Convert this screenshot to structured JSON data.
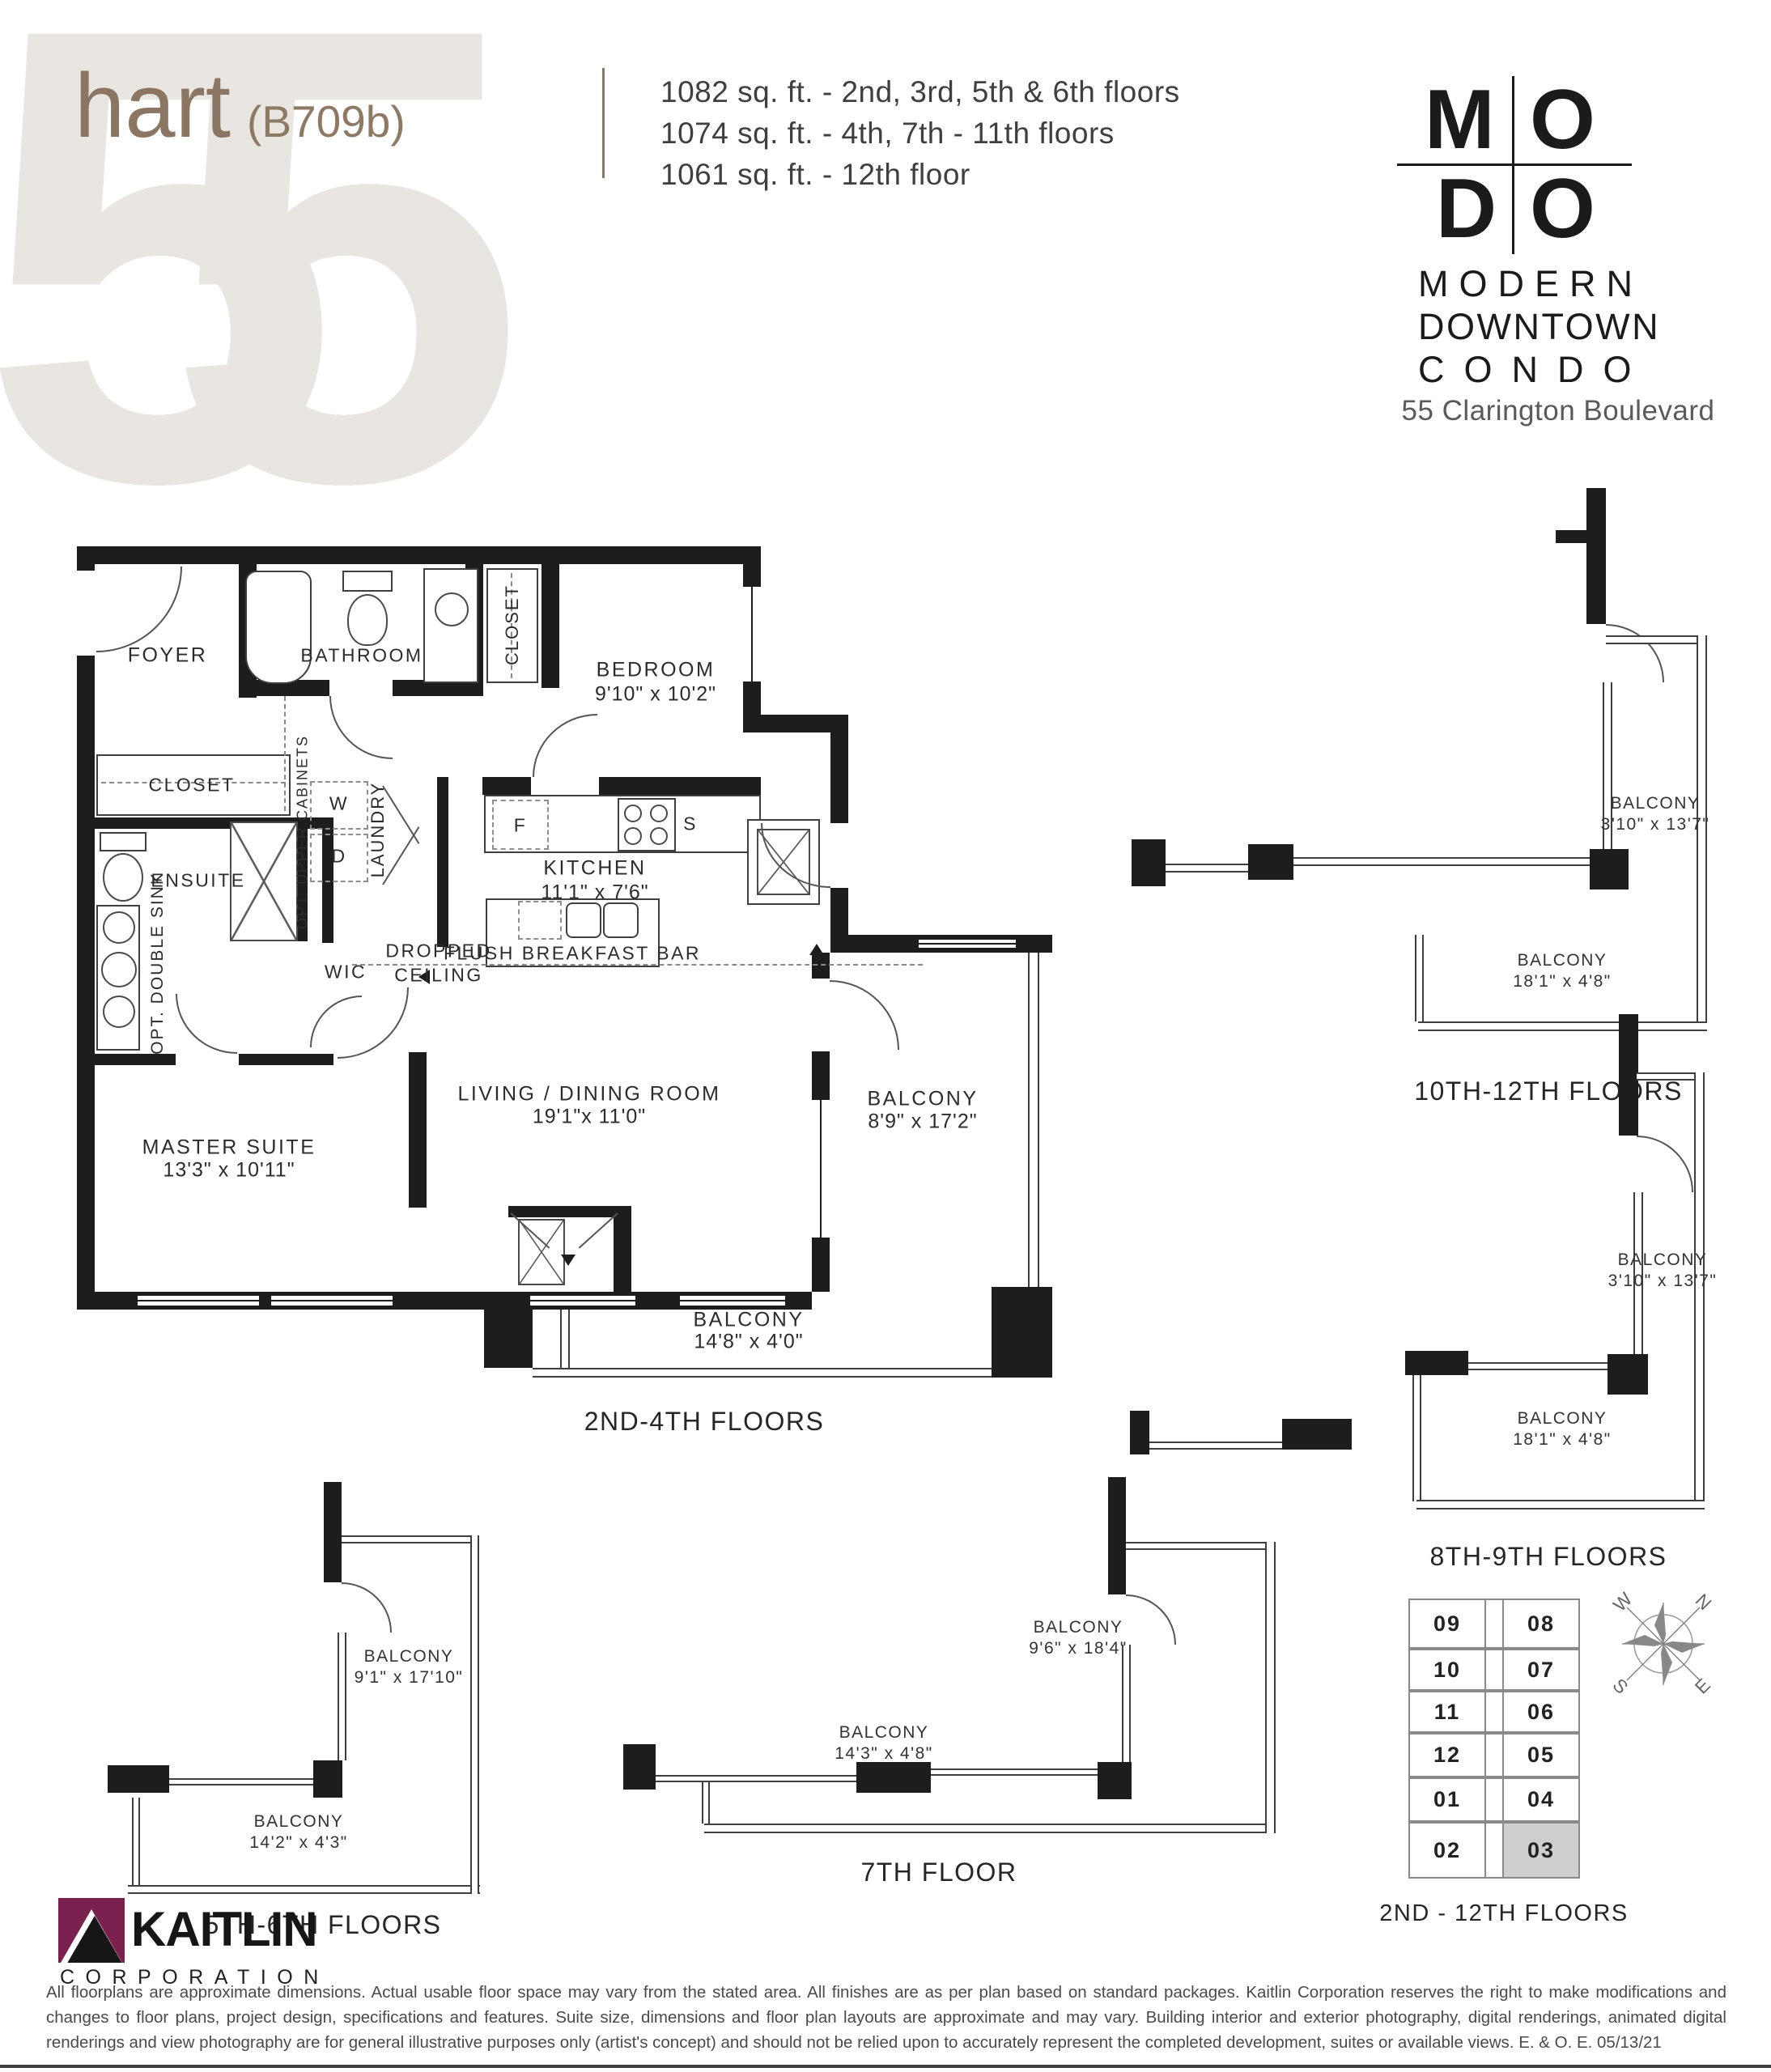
{
  "colors": {
    "accent_brown": "#8b7563",
    "wall_black": "#1d1d1d",
    "watermark_gray": "#e9e6e1",
    "kaitlin_maroon": "#7b2150",
    "highlight_gray": "#cfcfcf"
  },
  "header": {
    "watermark": "55",
    "title": "hart",
    "title_suffix": "(B709b)",
    "sqft_lines": [
      "1082 sq. ft. - 2nd, 3rd, 5th & 6th floors",
      "1074 sq. ft. - 4th, 7th - 11th floors",
      "1061 sq. ft. - 12th floor"
    ],
    "logo": {
      "l1": "M",
      "l2": "O",
      "l3": "D",
      "l4": "O",
      "word1": "MODERN",
      "word2": "DOWNTOWN",
      "word3": "CONDO"
    },
    "address": "55 Clarington Boulevard"
  },
  "main_plan": {
    "caption": "2ND-4TH FLOORS",
    "labels": {
      "foyer": "FOYER",
      "bathroom": "BATHROOM",
      "closet_top": "CLOSET",
      "closet_mid": "CLOSET",
      "bedroom_name": "BEDROOM",
      "bedroom_dims": "9'10\" x 10'2\"",
      "ensuite": "ENSUITE",
      "opt_double_sink": "OPT. DOUBLE SINK",
      "opt_upper_cabinets": "OPT. UPPER CABINETS",
      "laundry": "LAUNDRY",
      "washer": "W",
      "dryer": "D",
      "wic": "WIC",
      "kitchen_name": "KITCHEN",
      "kitchen_dims": "11'1\" x 7'6\"",
      "dropped_1": "DROPPED",
      "dropped_2": "CEILING",
      "breakfast_bar": "FLUSH BREAKFAST BAR",
      "fridge": "F",
      "stove": "S",
      "master_name": "MASTER SUITE",
      "master_dims": "13'3\" x 10'11\"",
      "living_name": "LIVING / DINING ROOM",
      "living_dims": "19'1\"x 11'0\"",
      "balcony_side_name": "BALCONY",
      "balcony_side_dims": "8'9\" x 17'2\"",
      "balcony_bottom_name": "BALCONY",
      "balcony_bottom_dims": "14'8\" x 4'0\""
    }
  },
  "variants": [
    {
      "caption": "10TH-12TH FLOORS",
      "b1_name": "BALCONY",
      "b1_dims": "3'10\" x 13'7\"",
      "b2_name": "BALCONY",
      "b2_dims": "18'1\" x 4'8\""
    },
    {
      "caption": "8TH-9TH FLOORS",
      "b1_name": "BALCONY",
      "b1_dims": "3'10\" x 13'7\"",
      "b2_name": "BALCONY",
      "b2_dims": "18'1\" x 4'8\""
    },
    {
      "caption": "5TH-6TH FLOORS",
      "b1_name": "BALCONY",
      "b1_dims": "9'1\" x 17'10\"",
      "b2_name": "BALCONY",
      "b2_dims": "14'2\" x 4'3\""
    },
    {
      "caption": "7TH FLOOR",
      "b1_name": "BALCONY",
      "b1_dims": "9'6\" x 18'4\"",
      "b2_name": "BALCONY",
      "b2_dims": "14'3\" x 4'8\""
    }
  ],
  "keyplan": {
    "caption": "2ND - 12TH FLOORS",
    "left_units": [
      "09",
      "10",
      "11",
      "12",
      "01",
      "02"
    ],
    "right_units": [
      "08",
      "07",
      "06",
      "05",
      "04",
      "03"
    ],
    "highlighted_unit": "03"
  },
  "compass": {
    "w": "W",
    "n": "N",
    "e": "E",
    "s": "S"
  },
  "footer": {
    "brand": "KAITLIN",
    "brand_sub": "CORPORATION",
    "disclaimer": "All floorplans are approximate dimensions. Actual usable floor space may vary from the stated area. All finishes are as per plan based on standard packages. Kaitlin Corporation reserves the right to make modifications and changes to floor plans, project design, specifications and features. Suite size, dimensions and floor plan layouts are approximate and may vary. Building interior and exterior photography, digital renderings, animated digital renderings and view photography are for general illustrative purposes only (artist's concept) and should not be relied upon to accurately represent the completed development, suites or available views. E. & O. E. 05/13/21"
  }
}
